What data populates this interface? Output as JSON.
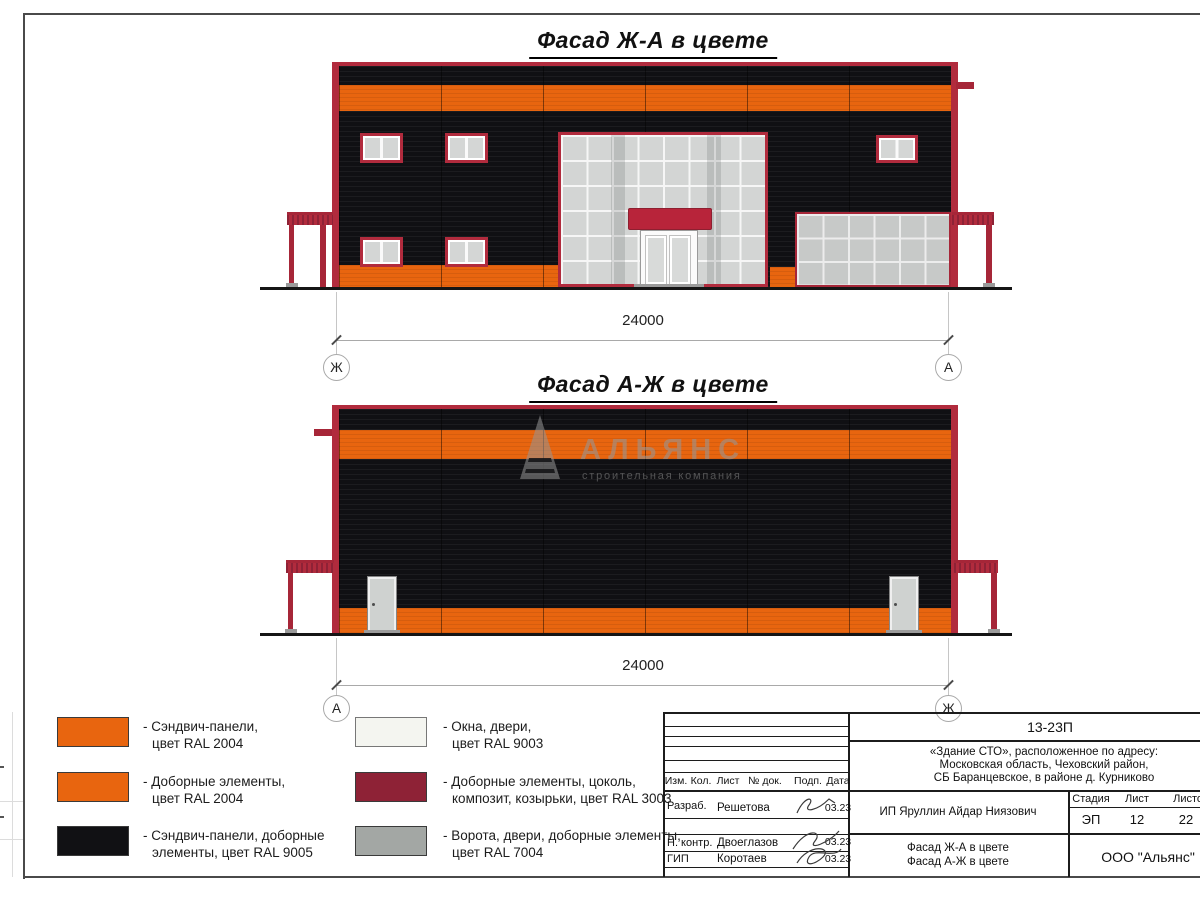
{
  "sheet": {
    "facade1": {
      "title": "Фасад Ж-А в цвете",
      "dim": "24000",
      "axis_left": "Ж",
      "axis_right": "А"
    },
    "facade2": {
      "title": "Фасад А-Ж в цвете",
      "dim": "24000",
      "axis_left": "А",
      "axis_right": "Ж"
    }
  },
  "watermark": {
    "name": "АЛЬЯНС",
    "subtitle": "строительная компания"
  },
  "legend": {
    "items": [
      {
        "color": "#e8650f",
        "lines": [
          "- Сэндвич-панели,",
          "цвет RAL 2004"
        ]
      },
      {
        "color": "#e8650f",
        "lines": [
          "- Доборные элементы,",
          "цвет RAL 2004"
        ]
      },
      {
        "color": "#111114",
        "lines": [
          "- Сэндвич-панели, доборные",
          "элементы, цвет RAL 9005"
        ]
      },
      {
        "color": "#f4f5f0",
        "lines": [
          "- Окна, двери,",
          "цвет RAL 9003"
        ]
      },
      {
        "color": "#8e2236",
        "lines": [
          "- Доборные элементы, цоколь,",
          "композит, козырьки, цвет RAL 3003"
        ]
      },
      {
        "color": "#a3a7a4",
        "lines": [
          "- Ворота, двери, доборные элементы,",
          "цвет RAL 7004"
        ]
      }
    ]
  },
  "stamp": {
    "doc_number": "13-23П",
    "object_address_lines": [
      "«Здание СТО», расположенное по адресу:",
      "Московская область, Чеховский район,",
      "СБ Баранцевское, в районе д. Курниково"
    ],
    "revision_headers": [
      "Изм.",
      "Кол.",
      "Лист",
      "№ док.",
      "Подп.",
      "Дата"
    ],
    "signature_rows": [
      {
        "role": "Разраб.",
        "name": "Решетова",
        "date": "03.23"
      },
      {
        "role": "Н. контр.",
        "name": "Двоеглазов",
        "date": "03.23"
      },
      {
        "role": "ГИП",
        "name": "Коротаев",
        "date": "03.23"
      }
    ],
    "client": "ИП Яруллин Айдар Ниязович",
    "stage_headers": [
      "Стадия",
      "Лист",
      "Листов"
    ],
    "stage": "ЭП",
    "sheet_no": "12",
    "sheets_total": "22",
    "sheet_titles": [
      "Фасад Ж-А в цвете",
      "Фасад А-Ж в цвете"
    ],
    "company": "ООО \"Альянс\""
  },
  "colors": {
    "panel_orange_ral2004": "#e8650f",
    "panel_black_ral9005": "#111114",
    "trim_red_ral3003": "#b12b3d",
    "window_white_ral9003": "#f4f5f0",
    "gate_grey_ral7004": "#a3a7a4"
  }
}
